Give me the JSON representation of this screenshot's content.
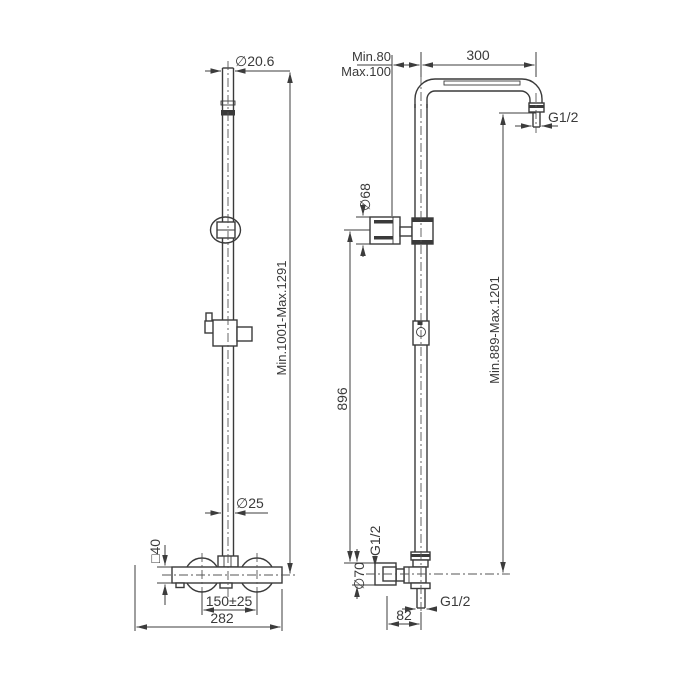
{
  "drawing_labels": {
    "front": {
      "head_dia": "∅20.6",
      "height_range": "Min.1001-Max.1291",
      "pipe_dia": "∅25",
      "body_size": "□40",
      "inlet_spacing": "150±25",
      "overall_width": "282"
    },
    "side": {
      "wall_min": "Min.80",
      "wall_max": "Max.100",
      "arm_reach": "300",
      "arm_thread": "G1/2",
      "bracket_dia": "∅68",
      "rail_length": "896",
      "head_height_range": "Min.889-Max.1201",
      "inlet_thread": "G1/2",
      "flange_dia": "∅70",
      "outlet_thread": "G1/2",
      "outlet_offset": "82"
    }
  }
}
